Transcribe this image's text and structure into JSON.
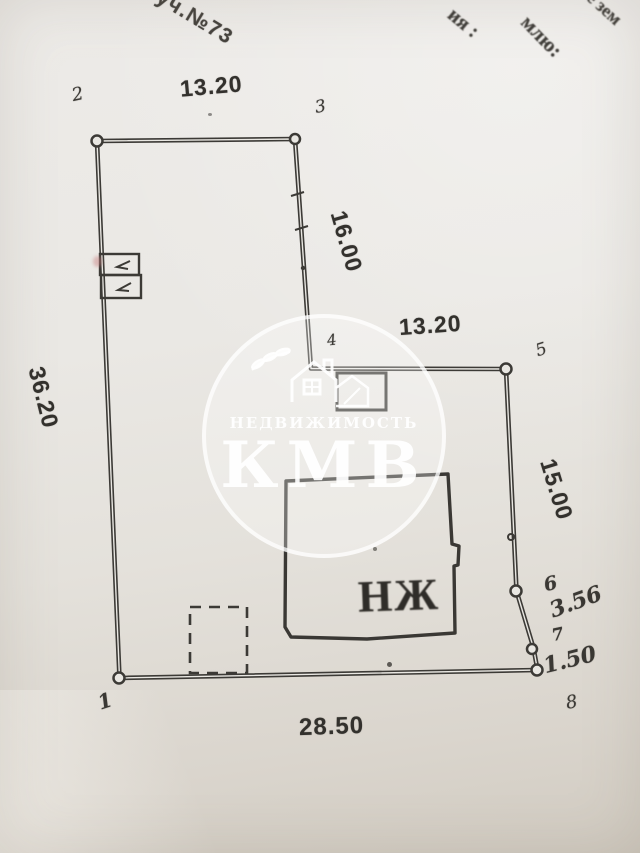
{
  "header": {
    "plot_label": "уч.№73",
    "fragments": {
      "f1": "ия :",
      "f2": "млю:",
      "f3": "е зем"
    }
  },
  "plan": {
    "dims": {
      "top": "13.20",
      "segment_3_4": "16.00",
      "segment_4_5": "13.20",
      "left": "36.20",
      "right": "15.00",
      "segment_6_7": "3.56",
      "segment_7_8": "1.50",
      "bottom": "28.50"
    },
    "points": {
      "p1": "1",
      "p2": "2",
      "p3": "3",
      "p4": "4",
      "p5": "5",
      "p6": "6",
      "p7": "7",
      "p8": "8"
    },
    "building_label": "НЖ"
  },
  "watermark": {
    "org_line": "НЕДВИЖИМОСТЬ",
    "brand": "КМВ"
  },
  "colors": {
    "paper": "#e9e7e2",
    "ink": "#3c3a36",
    "watermark_white": "#ffffff"
  }
}
